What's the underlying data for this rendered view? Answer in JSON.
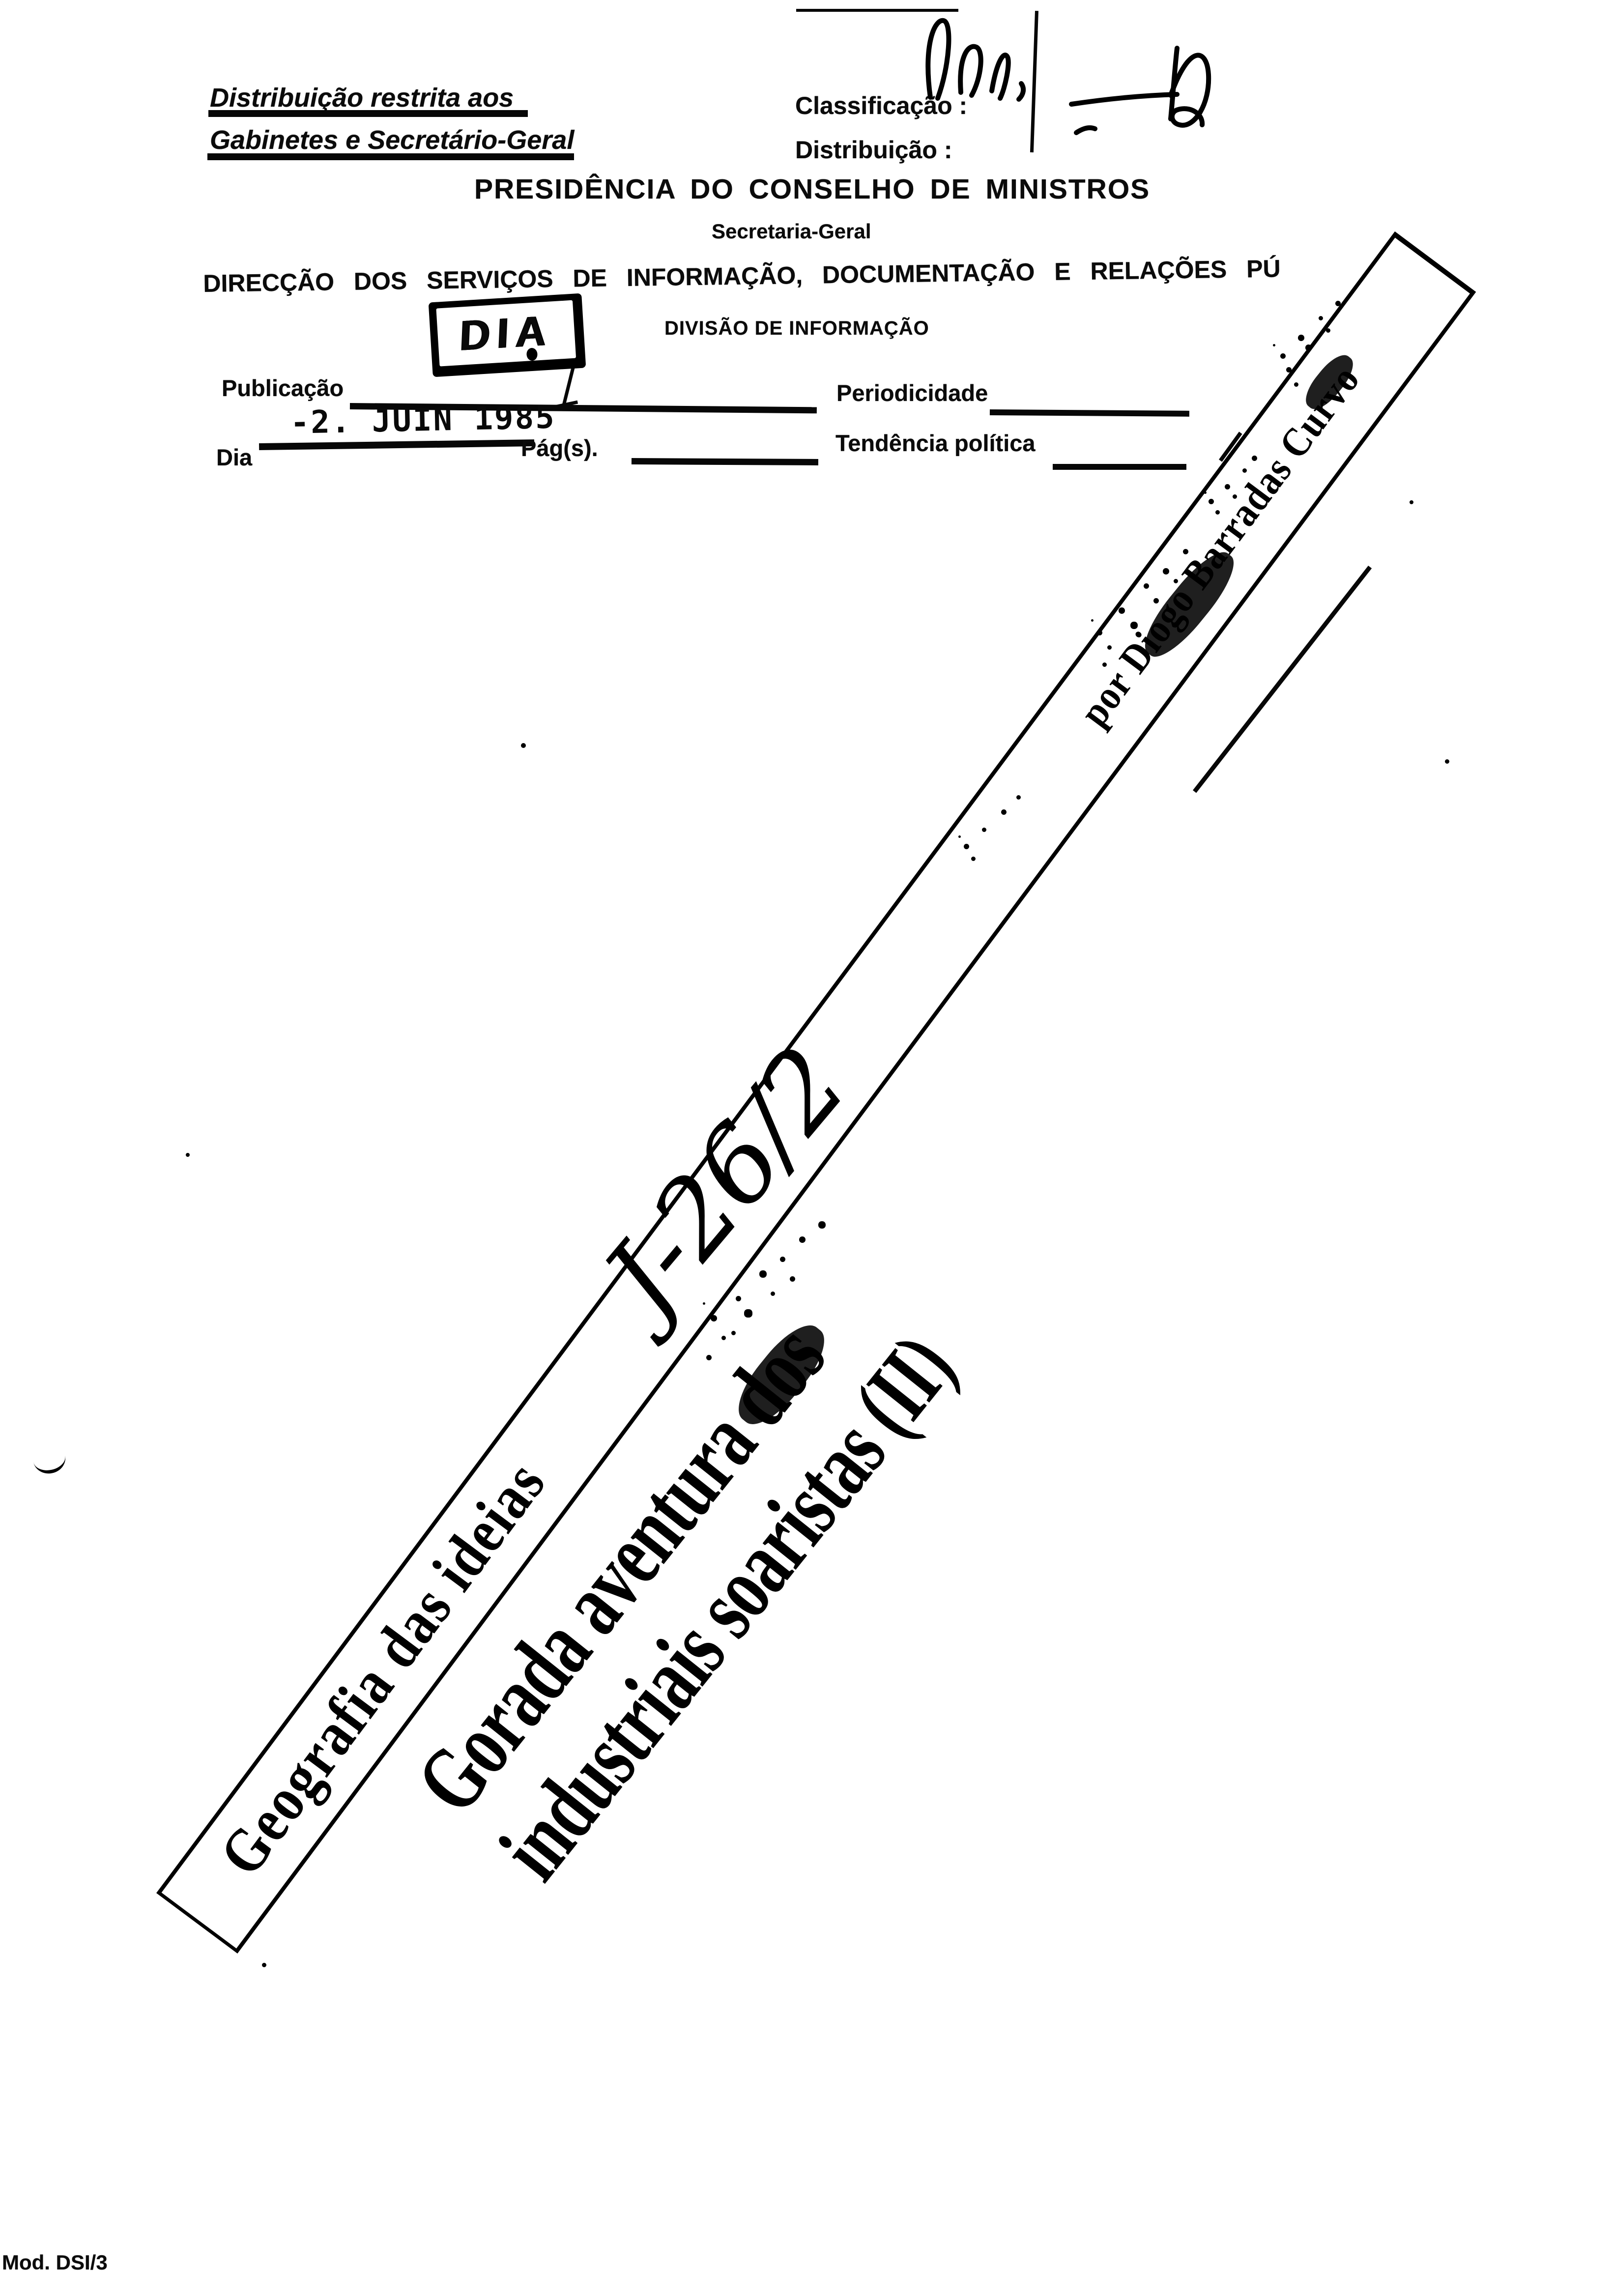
{
  "document": {
    "restricted": {
      "line1": "Distribuição restrita aos",
      "line2": "Gabinetes e Secretário-Geral"
    },
    "classification_label": "Classificação :",
    "distribution_label": "Distribuição :",
    "title": "PRESIDÊNCIA DO CONSELHO DE MINISTROS",
    "subtitle": "Secretaria-Geral",
    "directorate": "DIRECÇÃO DOS SERVIÇOS DE INFORMAÇÃO, DOCUMENTAÇÃO E RELAÇÕES PÚ",
    "division": "DIVISÃO DE INFORMAÇÃO",
    "stamp_text": "DIA",
    "fields": {
      "publication": "Publicação",
      "periodicity": "Periodicidade",
      "day": "Dia",
      "pages": "Pág(s).",
      "tendency": "Tendência política"
    },
    "date_stamp": "-2. JUIN 1985",
    "footer_model": "Mod. DSI/3"
  },
  "clipping": {
    "kicker": "Geografia das ideias",
    "headline": "Gorada aventura dos industriais soaristas (II)",
    "byline": "por Diogo Barradas Curvo",
    "handwritten_ref": "J-26/2"
  }
}
